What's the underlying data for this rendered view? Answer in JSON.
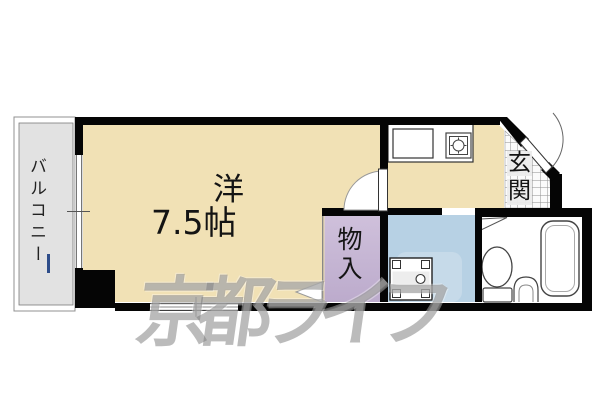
{
  "plan": {
    "labels": {
      "balcony": "バルコニー",
      "room_type": "洋",
      "room_size": "7.5帖",
      "closet": "物入",
      "entrance": "玄関",
      "entrance_char1": "玄",
      "entrance_char2": "関"
    },
    "room_size_tatami": 7.5,
    "watermark_text": "京都ライフ",
    "colors": {
      "room_floor": "#f1e1b5",
      "balcony_floor": "#e2e2e2",
      "closet_floor": "#c6b5d3",
      "washroom_floor": "#b7d1e4",
      "wall": "#000000",
      "watermark": "#8a8a8a",
      "background": "#ffffff"
    }
  }
}
